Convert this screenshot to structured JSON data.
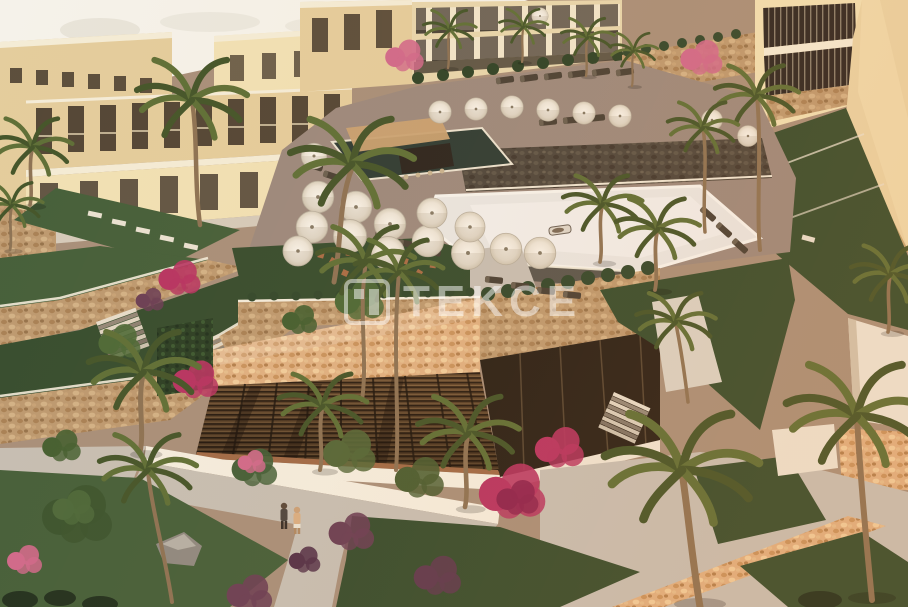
{
  "image": {
    "kind": "3d-architectural-rendering",
    "scene": "Aerial sunset view of a Mediterranean resort residence: beige apartment blocks, swimming pools with white parasols and loungers, stone terrace walls with stairs, a louvered clubhouse, lawns, palm trees, bougainvillea and a garden path with two people walking"
  },
  "watermark": {
    "text": "TEKCE",
    "logo": "tekce-box-logo",
    "color": "#ffffff",
    "opacity": 0.5
  },
  "palette": {
    "sky": "#f5f2ea",
    "building-light": "#f1e1b5",
    "building-mid": "#e4cd9d",
    "window-dark": "#3b3026",
    "roof-light": "#f4ecd6",
    "roof-main": "#e9d4a6",
    "lawn": "#46603b",
    "lawn-dark": "#374e30",
    "deck": "#9c8a7e",
    "pool-bright": "#e9e7e3",
    "pool-dark": "#2f3d36",
    "path": "#c6bfb4",
    "palm-frond": "#5f7038",
    "palm-frond-dark": "#45562b",
    "palm-trunk": "#8d7355",
    "flower-pink": "#d06a8c",
    "flower-magenta": "#b73563",
    "flower-purple": "#6b4056",
    "terracotta": "#b5714a",
    "white-trim": "#f3ecdc"
  }
}
